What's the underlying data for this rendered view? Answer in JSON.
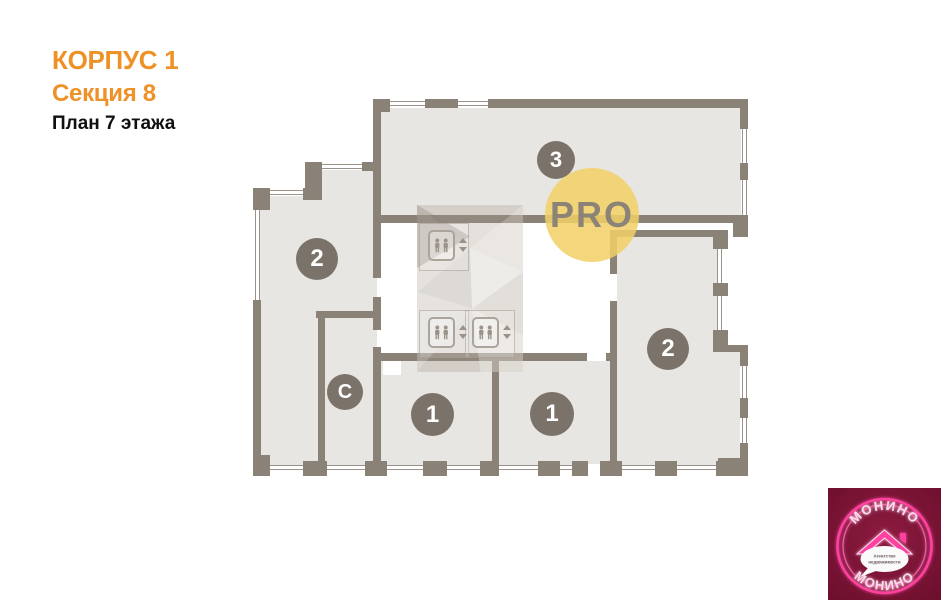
{
  "header": {
    "building": "КОРПУС 1",
    "section": "Секция 8",
    "floor_plan": "План 7 этажа"
  },
  "plan": {
    "watermark_label": "PRO",
    "rooms": [
      {
        "id": "room-3",
        "label": "3"
      },
      {
        "id": "room-2-left",
        "label": "2"
      },
      {
        "id": "room-2-right",
        "label": "2"
      },
      {
        "id": "room-1-left",
        "label": "1"
      },
      {
        "id": "room-1-right",
        "label": "1"
      },
      {
        "id": "room-studio",
        "label": "С"
      }
    ]
  },
  "logo": {
    "arc_top": "МОНИНО",
    "arc_bottom": "МОНИНО",
    "tagline_line1": "Агентство",
    "tagline_line2": "недвижимости"
  },
  "colors": {
    "accent_orange": "#EE9227",
    "wall": "#8A8177",
    "room_fill": "#E8E6E2",
    "badge_grey": "#7B7369",
    "pro_yellow": "#F2D36B",
    "logo_bg": "#7A1534",
    "logo_pink": "#FF43A1"
  }
}
